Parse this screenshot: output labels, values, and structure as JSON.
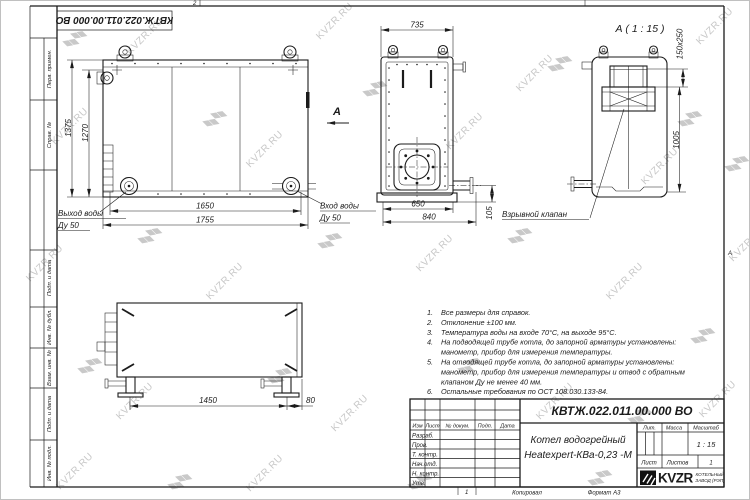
{
  "page": {
    "stamp_top": "КВТЖ.022.011.00.000 ВО",
    "watermark_text": "KVZR.RU",
    "zone_top": "2",
    "zone_right": "А",
    "zone_bottom": "1"
  },
  "margin": {
    "perv_primen": "Перв. примен.",
    "sprav_no": "Справ. №",
    "podp_data_1": "Подп. и дата",
    "inv_dubl": "Инв. № дубл.",
    "vzam_inv": "Взам. инв. №",
    "podp_data_2": "Подп. и дата",
    "inv_podl": "Инв. № подл."
  },
  "front_view": {
    "dim_height_outer": "1375",
    "dim_height_inner": "1270",
    "dim_width_inner": "1650",
    "dim_width_outer": "1755",
    "outlet_label_1": "Выход воды",
    "outlet_label_2": "Ду 50",
    "view_arrow_label": "А"
  },
  "top_view": {
    "dim_width_top": "735",
    "dim_width_inner": "650",
    "dim_width_outer": "840",
    "dim_offset": "105",
    "inlet_label_1": "Вход воды",
    "inlet_label_2": "Ду 50"
  },
  "detail_view": {
    "title": "А ( 1 : 15 )",
    "dim_valve": "150x250",
    "dim_height": "1005",
    "valve_label": "Взрывной клапан"
  },
  "bottom_view": {
    "dim_legs": "1450",
    "dim_offset": "80"
  },
  "notes": [
    {
      "num": "1.",
      "text": "Все размеры для справок."
    },
    {
      "num": "2.",
      "text": "Отклонение ±100 мм."
    },
    {
      "num": "3.",
      "text": "Температура воды на входе 70°С, на выходе 95°С."
    },
    {
      "num": "4.",
      "text": "На подводящей трубе котла, до запорной арматуры установлены:"
    },
    {
      "num": "",
      "text": "манометр, прибор для измерения температуры."
    },
    {
      "num": "5.",
      "text": "На отводящей трубе котла, до запорной арматуры установлены:"
    },
    {
      "num": "",
      "text": "манометр, прибор для измерения температуры и отвод с обратным"
    },
    {
      "num": "",
      "text": "клапаном Ду не менее 40 мм."
    },
    {
      "num": "6.",
      "text": "Остальные требования по ОСТ 108.030.133-84."
    }
  ],
  "title_block": {
    "doc_number": "КВТЖ.022.011.00.000 ВО",
    "name_line1": "Котел водогрейный",
    "name_line2": "Heatexpert-КВа-0,23 -М",
    "col_izm": "Изм",
    "col_list": "Лист",
    "col_dokum": "№ докум.",
    "col_podp": "Подп.",
    "col_data": "Дата",
    "row_razrab": "Разраб.",
    "row_prov": "Пров.",
    "row_tkontr": "Т. контр.",
    "row_nachotd": "Нач.отд.",
    "row_nkontr": "Н. контр.",
    "row_utv": "Утв.",
    "lit_label": "Лит.",
    "mass_label": "Масса",
    "scale_label": "Масштаб",
    "scale_value": "1 : 15",
    "sheet_label": "Лист",
    "sheets_label": "Листов",
    "sheets_value": "1",
    "logo_text": "KVZR",
    "company_line1": "КОТЕЛЬНЫЙ",
    "company_line2": "ЗАВОД (РЭП)",
    "copied_label": "Копировал",
    "format_label": "Формат А3"
  }
}
